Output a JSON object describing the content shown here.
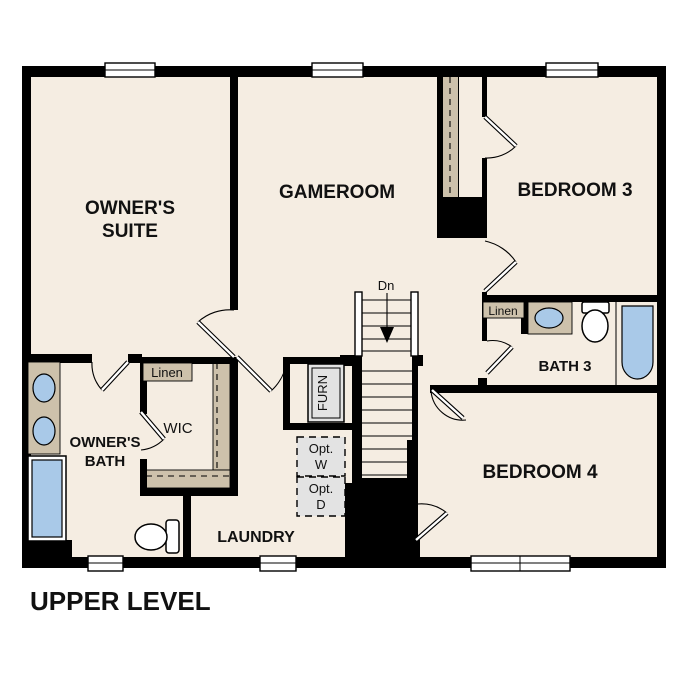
{
  "title": "UPPER LEVEL",
  "colors": {
    "floor": "#f5ede2",
    "wall": "#000000",
    "wood": "#cdc1ab",
    "fixture_blue": "#a9c9e8",
    "appliance_gray": "#e3e3e3",
    "background": "#ffffff"
  },
  "rooms": {
    "owners_suite": {
      "label_line1": "OWNER'S",
      "label_line2": "SUITE"
    },
    "gameroom": {
      "label": "GAMEROOM"
    },
    "bedroom3": {
      "label": "BEDROOM 3"
    },
    "bath3": {
      "label": "BATH 3"
    },
    "bedroom4": {
      "label": "BEDROOM 4"
    },
    "owners_bath": {
      "label_line1": "OWNER'S",
      "label_line2": "BATH"
    },
    "wic": {
      "label": "WIC"
    },
    "laundry": {
      "label": "LAUNDRY"
    }
  },
  "closets": {
    "linen_hall": {
      "label": "Linen"
    },
    "linen_bath3": {
      "label": "Linen"
    }
  },
  "stairs": {
    "direction_label": "Dn"
  },
  "equipment": {
    "furnace": {
      "label": "FURN"
    },
    "optional_washer": {
      "label_line1": "Opt.",
      "label_line2": "W"
    },
    "optional_dryer": {
      "label_line1": "Opt.",
      "label_line2": "D"
    }
  }
}
